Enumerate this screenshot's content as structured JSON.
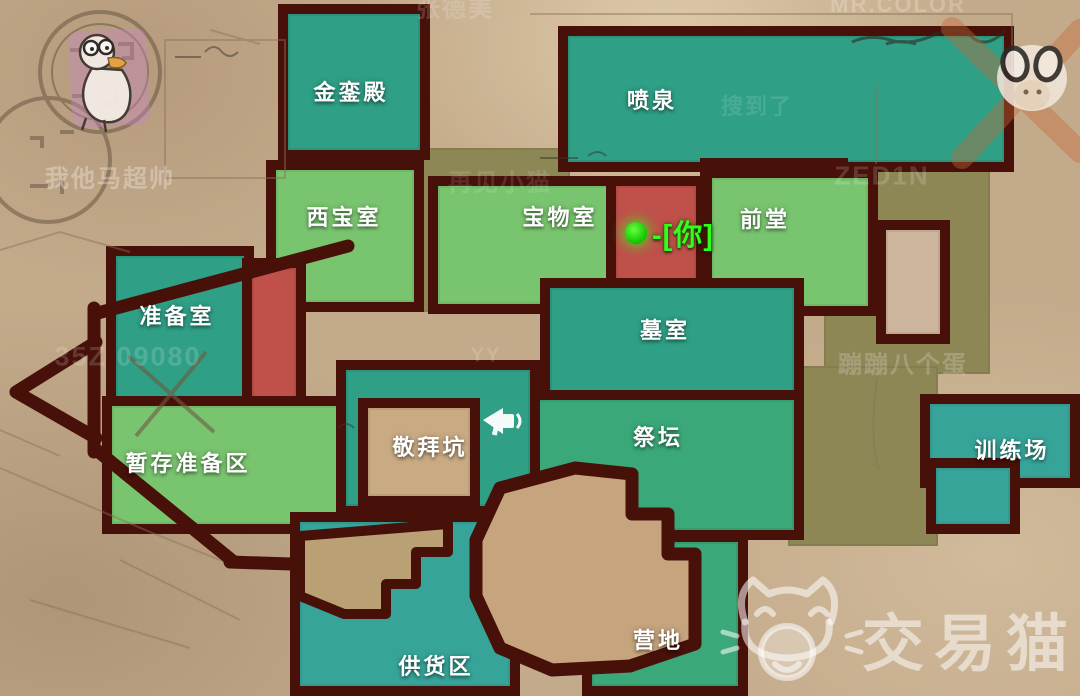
{
  "map": {
    "colors": {
      "wall": "#471009",
      "teal": "#2f9f86",
      "teal_blue": "#37a49a",
      "green": "#3aa878",
      "light_green": "#79c56f",
      "red": "#c0504a",
      "tan_room": "#c9aa83",
      "olive": "#8d8756",
      "pink_tan": "#cdb49c",
      "bg": "#c3aa8b",
      "player_green": "#2fff1a",
      "brand_white": "rgba(255,255,255,0.52)"
    },
    "rooms": [
      {
        "id": "olive-corridor-west",
        "label": "",
        "color": "olive",
        "x": 418,
        "y": 148,
        "w": 152,
        "h": 164,
        "wall": false
      },
      {
        "id": "olive-corridor-east",
        "label": "",
        "color": "olive",
        "x": 824,
        "y": 164,
        "w": 166,
        "h": 210,
        "wall": false
      },
      {
        "id": "olive-corridor-southeast",
        "label": "",
        "color": "olive",
        "x": 788,
        "y": 366,
        "w": 150,
        "h": 180,
        "wall": false
      },
      {
        "id": "golden-hall",
        "label": "金銮殿",
        "color": "teal",
        "x": 278,
        "y": 4,
        "w": 152,
        "h": 156,
        "lx": 351,
        "ly": 91,
        "wall": true
      },
      {
        "id": "fountain",
        "label": "喷泉",
        "color": "teal",
        "x": 558,
        "y": 26,
        "w": 456,
        "h": 146,
        "lx": 652,
        "ly": 99,
        "wall": true
      },
      {
        "id": "fountain-south",
        "label": "",
        "color": "teal",
        "x": 700,
        "y": 158,
        "w": 148,
        "h": 88,
        "wall": true
      },
      {
        "id": "west-treasure",
        "label": "西宝室",
        "color": "light_green",
        "x": 266,
        "y": 160,
        "w": 158,
        "h": 152,
        "lx": 344,
        "ly": 216,
        "wall": true
      },
      {
        "id": "treasure-room",
        "label": "宝物室",
        "color": "light_green",
        "x": 428,
        "y": 176,
        "w": 200,
        "h": 138,
        "lx": 560,
        "ly": 216,
        "wall": true
      },
      {
        "id": "front-hall",
        "label": "前堂",
        "color": "light_green",
        "x": 702,
        "y": 168,
        "w": 176,
        "h": 148,
        "lx": 765,
        "ly": 218,
        "wall": true
      },
      {
        "id": "you-corridor",
        "label": "",
        "color": "red",
        "x": 606,
        "y": 176,
        "w": 100,
        "h": 126,
        "wall": true
      },
      {
        "id": "prep-room",
        "label": "准备室",
        "color": "teal",
        "x": 106,
        "y": 246,
        "w": 148,
        "h": 182,
        "lx": 177,
        "ly": 315,
        "wall": true
      },
      {
        "id": "red-strip",
        "label": "",
        "color": "red",
        "x": 242,
        "y": 258,
        "w": 64,
        "h": 230,
        "wall": true
      },
      {
        "id": "staging-area",
        "label": "暂存准备区",
        "color": "light_green",
        "x": 102,
        "y": 396,
        "w": 262,
        "h": 138,
        "lx": 188,
        "ly": 462,
        "wall": true
      },
      {
        "id": "tomb",
        "label": "墓室",
        "color": "teal",
        "x": 540,
        "y": 278,
        "w": 264,
        "h": 156,
        "lx": 665,
        "ly": 329,
        "wall": true
      },
      {
        "id": "altar",
        "label": "祭坛",
        "color": "green",
        "x": 524,
        "y": 390,
        "w": 280,
        "h": 150,
        "lx": 658,
        "ly": 436,
        "wall": true
      },
      {
        "id": "worship-zone",
        "label": "",
        "color": "teal",
        "x": 336,
        "y": 360,
        "w": 204,
        "h": 156,
        "wall": true
      },
      {
        "id": "worship-pit",
        "label": "敬拜坑",
        "color": "tan_room",
        "x": 358,
        "y": 398,
        "w": 122,
        "h": 108,
        "lx": 430,
        "ly": 446,
        "wall": true
      },
      {
        "id": "training-ground",
        "label": "训练场",
        "color": "teal_blue",
        "x": 920,
        "y": 394,
        "w": 160,
        "h": 94,
        "lx": 1012,
        "ly": 449,
        "wall": true
      },
      {
        "id": "training-annex",
        "label": "",
        "color": "teal_blue",
        "x": 926,
        "y": 458,
        "w": 94,
        "h": 76,
        "wall": true
      },
      {
        "id": "pink-room",
        "label": "",
        "color": "pink_tan",
        "x": 876,
        "y": 220,
        "w": 74,
        "h": 124,
        "wall": true
      },
      {
        "id": "camp",
        "label": "营地",
        "color": "green",
        "x": 582,
        "y": 532,
        "w": 166,
        "h": 164,
        "lx": 658,
        "ly": 639,
        "wall": true
      },
      {
        "id": "supply-area",
        "label": "供货区",
        "color": "teal_blue",
        "x": 290,
        "y": 512,
        "w": 230,
        "h": 184,
        "lx": 436,
        "ly": 665,
        "wall": true
      }
    ],
    "player": {
      "label": "-[你]",
      "dot_x": 636,
      "dot_y": 233,
      "text_x": 652,
      "text_y": 233
    },
    "watermarks": [
      {
        "text": "我他马超帅",
        "x": 110,
        "y": 176,
        "size": 24,
        "opacity": 0.3
      },
      {
        "text": "张德美",
        "x": 455,
        "y": 6,
        "size": 24,
        "opacity": 0.16
      },
      {
        "text": "MR.COLOR",
        "x": 898,
        "y": 5,
        "size": 22,
        "opacity": 0.22
      },
      {
        "text": "搜到了",
        "x": 757,
        "y": 105,
        "size": 22,
        "opacity": 0.12
      },
      {
        "text": "再见小猫",
        "x": 500,
        "y": 180,
        "size": 24,
        "opacity": 0.12
      },
      {
        "text": "ZED1N",
        "x": 882,
        "y": 176,
        "size": 26,
        "opacity": 0.16
      },
      {
        "text": "35Z 09080",
        "x": 128,
        "y": 357,
        "size": 27,
        "opacity": 0.16
      },
      {
        "text": "YY",
        "x": 486,
        "y": 356,
        "size": 20,
        "opacity": 0.15
      },
      {
        "text": "蹦蹦八个蛋",
        "x": 903,
        "y": 362,
        "size": 24,
        "opacity": 0.2
      }
    ],
    "brand": {
      "text": "交易猫"
    }
  }
}
